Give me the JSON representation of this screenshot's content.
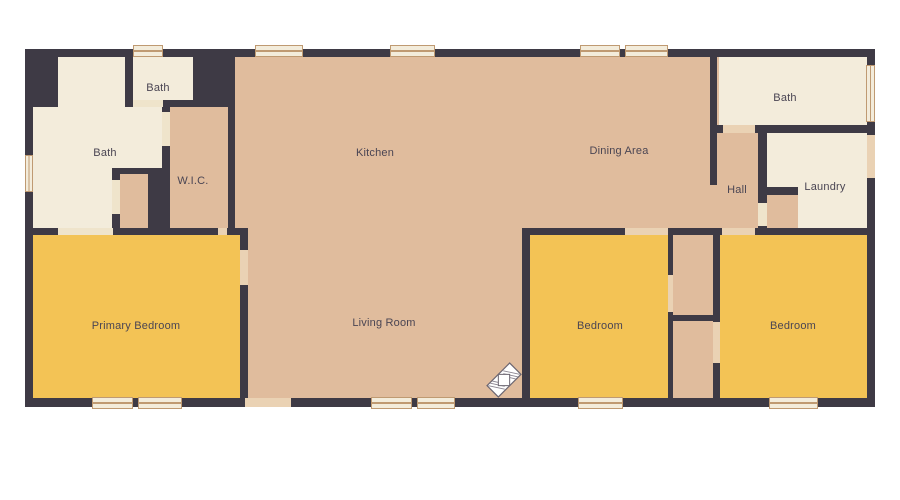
{
  "floorplan": {
    "rooms": {
      "bath_small": {
        "label": "Bath"
      },
      "bath_left": {
        "label": "Bath"
      },
      "wic": {
        "label": "W.I.C."
      },
      "kitchen": {
        "label": "Kitchen"
      },
      "dining_area": {
        "label": "Dining Area"
      },
      "bath_right": {
        "label": "Bath"
      },
      "hall": {
        "label": "Hall"
      },
      "laundry": {
        "label": "Laundry"
      },
      "primary_bedroom": {
        "label": "Primary Bedroom"
      },
      "living_room": {
        "label": "Living Room"
      },
      "bedroom_middle": {
        "label": "Bedroom"
      },
      "bedroom_right": {
        "label": "Bedroom"
      }
    },
    "icons": [
      {
        "name": "compass-icon"
      }
    ],
    "palette": {
      "background": "#ffffff",
      "wall": "#3e3a45",
      "open_area": "#e0bc9d",
      "bedroom": "#f3c355",
      "bath": "#f3ecdb",
      "door_opening": "#ead2b4",
      "door_opening_cream": "#efe4cb",
      "window_fill": "#f3ecdb",
      "window_frame": "#bf9a72",
      "label_text": "#4a4553"
    }
  }
}
